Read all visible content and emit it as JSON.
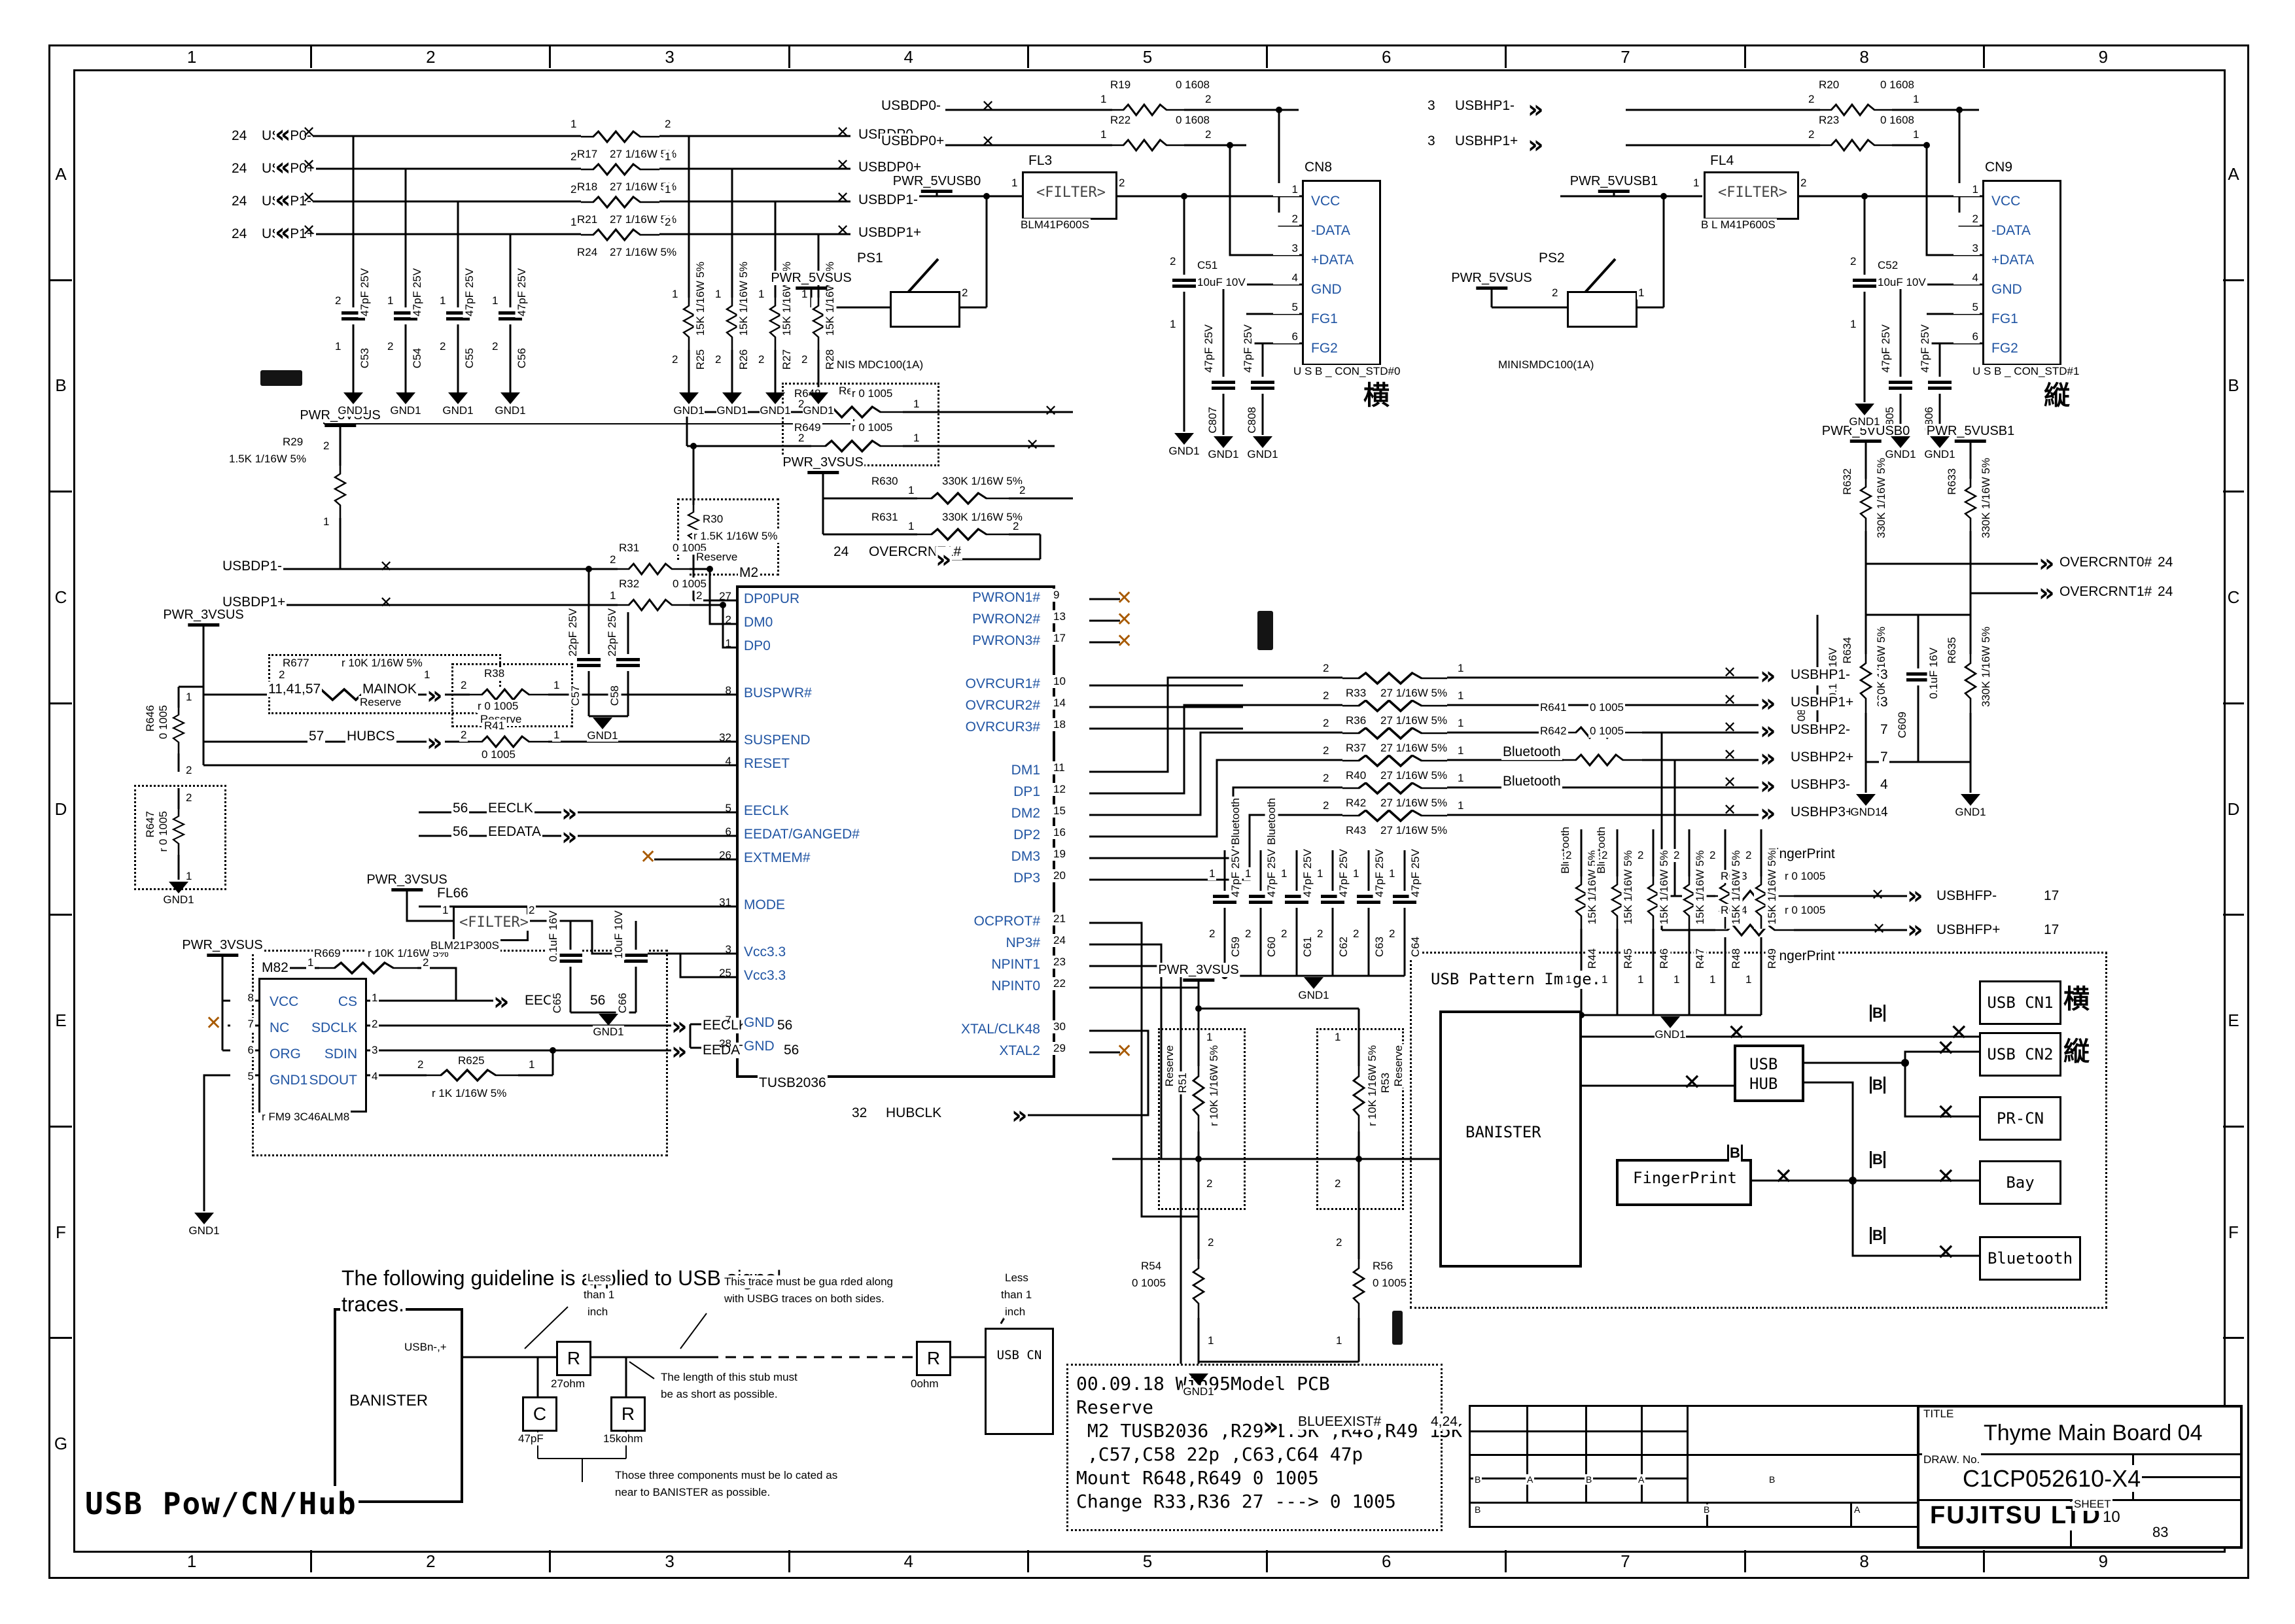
{
  "icons": {
    "chev_l": "«",
    "chev_r": "»",
    "x": "✕"
  },
  "sym": {
    "gnd": "GND1",
    "pwr3": "PWR_3VSUS",
    "pwr5": "PWR_5VSUS",
    "pwr5u0": "PWR_5VUSB0",
    "pwr5u1": "PWR_5VUSB1"
  },
  "frame": {
    "cols": [
      "1",
      "2",
      "3",
      "4",
      "5",
      "6",
      "7",
      "8",
      "9"
    ],
    "rows": [
      "A",
      "B",
      "C",
      "D",
      "E",
      "F",
      "G"
    ]
  },
  "big_label": "USB  Pow/CN/Hub",
  "title_block": {
    "title_label": "TITLE",
    "title": "Thyme Main Board 04",
    "draw_label": "DRAW. No.",
    "draw_no": "C1CP052610-X4",
    "company": "FUJITSU LTD.",
    "sheet_label": "SHEET",
    "sheet_no": "10",
    "sheet_total": "83"
  },
  "rev": {
    "r1": [
      "B",
      "A",
      "B",
      "A",
      "B"
    ],
    "r2": [
      "B",
      "B",
      "A"
    ]
  },
  "notes": {
    "lines": [
      "00.09.18 Win95Model PCB",
      "Reserve",
      " M2 TUSB2036 ,R29 1.5K ,R48,R49 15K",
      " ,C57,C58 22p ,C63,C64 47p",
      "Mount R648,R649 0 1005",
      "Change R33,R36 27 ---> 0 1005"
    ]
  },
  "inputs": {
    "rows": [
      {
        "page": "24",
        "net": "USBP0-",
        "ref": "R17",
        "val": "27 1/16W 5%",
        "pa": "1",
        "pb": "2",
        "out": "USBDP0-"
      },
      {
        "page": "24",
        "net": "USBP0+",
        "ref": "R18",
        "val": "27 1/16W 5%",
        "pa": "2",
        "pb": "1",
        "out": "USBDP0+"
      },
      {
        "page": "24",
        "net": "USBP1-",
        "ref": "R21",
        "val": "27 1/16W 5%",
        "pa": "2",
        "pb": "1",
        "out": "USBDP1-"
      },
      {
        "page": "24",
        "net": "USBP1+",
        "ref": "R24",
        "val": "27 1/16W 5%",
        "pa": "1",
        "pb": "2",
        "out": "USBDP1+"
      }
    ],
    "caps": [
      {
        "ref": "C53",
        "val": "47pF 25V",
        "pa": "2",
        "pb": "1"
      },
      {
        "ref": "C54",
        "val": "47pF 25V",
        "pa": "1",
        "pb": "2"
      },
      {
        "ref": "C55",
        "val": "47pF 25V",
        "pa": "1",
        "pb": "2"
      },
      {
        "ref": "C56",
        "val": "47pF 25V",
        "pa": "1",
        "pb": "2"
      }
    ],
    "pulls": [
      {
        "ref": "R25",
        "val": "15K 1/16W 5%",
        "pa": "1",
        "pb": "2"
      },
      {
        "ref": "R26",
        "val": "15K 1/16W 5%",
        "pa": "1",
        "pb": "2"
      },
      {
        "ref": "R27",
        "val": "15K 1/16W 5%",
        "pa": "1",
        "pb": "2"
      },
      {
        "ref": "R28",
        "val": "15K 1/16W 5%",
        "pa": "1",
        "pb": "2"
      }
    ]
  },
  "port0": {
    "net_m": "USBDP0-",
    "net_p": "USBDP0+",
    "rm": {
      "ref": "R19",
      "val": "0 1608",
      "pa": "1",
      "pb": "2"
    },
    "rp": {
      "ref": "R22",
      "val": "0 1608",
      "pa": "1",
      "pb": "2"
    },
    "fl": {
      "ref": "FL3",
      "text": "<FILTER>",
      "part": "BLM41P600S",
      "pa": "1",
      "pb": "2"
    },
    "ps": {
      "ref": "PS1",
      "part": "MINIS MDC100(1A)",
      "pb": "2"
    },
    "cap": {
      "ref": "C51",
      "val": "10uF 10V",
      "pa": "2",
      "pb": "1"
    },
    "c_a": {
      "ref": "C807",
      "val": "47pF 25V"
    },
    "c_b": {
      "ref": "C808",
      "val": "47pF 25V"
    },
    "cn": {
      "ref": "CN8",
      "part": "U S B _ CON_STD#0",
      "mark": "横",
      "nums": [
        "1",
        "2",
        "3",
        "4",
        "5",
        "6"
      ],
      "pins": [
        "VCC",
        "-DATA",
        "+DATA",
        "GND",
        "FG1",
        "FG2"
      ]
    }
  },
  "port1": {
    "net_m_pg": "3",
    "net_m": "USBHP1-",
    "net_p_pg": "3",
    "net_p": "USBHP1+",
    "rm": {
      "ref": "R20",
      "val": "0 1608",
      "pa": "2",
      "pb": "1"
    },
    "rp": {
      "ref": "R23",
      "val": "0 1608",
      "pa": "2",
      "pb": "1"
    },
    "fl": {
      "ref": "FL4",
      "text": "<FILTER>",
      "part": "B L M41P600S",
      "pa": "1",
      "pb": "2"
    },
    "ps": {
      "ref": "PS2",
      "part": "MINISMDC100(1A)",
      "pa": "2",
      "pb": "1"
    },
    "cap": {
      "ref": "C52",
      "val": "10uF 10V",
      "pa": "2",
      "pb": "1"
    },
    "c_a": {
      "ref": "C805",
      "val": "47pF 25V"
    },
    "c_b": {
      "ref": "C806",
      "val": "47pF 25V"
    },
    "cn": {
      "ref": "CN9",
      "part": "U S B _ CON_STD#1",
      "mark": "縦",
      "nums": [
        "1",
        "2",
        "3",
        "4",
        "5",
        "6"
      ],
      "pins": [
        "VCC",
        "-DATA",
        "+DATA",
        "GND",
        "FG1",
        "FG2"
      ]
    }
  },
  "chip": {
    "ref": "M2",
    "part": "TUSB2036",
    "left": [
      {
        "num": "27",
        "name": "DP0PUR"
      },
      {
        "num": "2",
        "name": "DM0"
      },
      {
        "num": "1",
        "name": "DP0"
      },
      {
        "num": "",
        "name": ""
      },
      {
        "num": "8",
        "name": "BUSPWR#"
      },
      {
        "num": "",
        "name": ""
      },
      {
        "num": "32",
        "name": "SUSPEND"
      },
      {
        "num": "4",
        "name": "RESET"
      },
      {
        "num": "",
        "name": ""
      },
      {
        "num": "5",
        "name": "EECLK"
      },
      {
        "num": "6",
        "name": "EEDAT/GANGED#"
      },
      {
        "num": "26",
        "name": "EXTMEM#"
      },
      {
        "num": "",
        "name": ""
      },
      {
        "num": "31",
        "name": "MODE"
      },
      {
        "num": "",
        "name": ""
      },
      {
        "num": "3",
        "name": "Vcc3.3"
      },
      {
        "num": "25",
        "name": "Vcc3.3"
      },
      {
        "num": "",
        "name": ""
      },
      {
        "num": "7",
        "name": "GND"
      },
      {
        "num": "28",
        "name": "GND"
      }
    ],
    "right": [
      {
        "num": "9",
        "name": "PWRON1#"
      },
      {
        "num": "13",
        "name": "PWRON2#"
      },
      {
        "num": "17",
        "name": "PWRON3#"
      },
      {
        "num": "",
        "name": ""
      },
      {
        "num": "10",
        "name": "OVRCUR1#"
      },
      {
        "num": "14",
        "name": "OVRCUR2#"
      },
      {
        "num": "18",
        "name": "OVRCUR3#"
      },
      {
        "num": "",
        "name": ""
      },
      {
        "num": "11",
        "name": "DM1"
      },
      {
        "num": "12",
        "name": "DP1"
      },
      {
        "num": "15",
        "name": "DM2"
      },
      {
        "num": "16",
        "name": "DP2"
      },
      {
        "num": "19",
        "name": "DM3"
      },
      {
        "num": "20",
        "name": "DP3"
      },
      {
        "num": "",
        "name": ""
      },
      {
        "num": "21",
        "name": "OCPROT#"
      },
      {
        "num": "24",
        "name": "NP3#"
      },
      {
        "num": "23",
        "name": "NPINT1"
      },
      {
        "num": "22",
        "name": "NPINT0"
      },
      {
        "num": "",
        "name": ""
      },
      {
        "num": "30",
        "name": "XTAL/CLK48"
      },
      {
        "num": "29",
        "name": "XTAL2"
      }
    ]
  },
  "hubclk": {
    "page": "32",
    "net": "HUBCLK"
  },
  "midleft": {
    "r29": {
      "ref": "R29",
      "val": "1.5K 1/16W 5%",
      "pa": "2",
      "pb": "1"
    },
    "net_m": "USBDP1-",
    "net_p": "USBDP1+",
    "r31": {
      "ref": "R31",
      "val": "0 1005",
      "pa": "2",
      "pb": "1"
    },
    "r32": {
      "ref": "R32",
      "val": "0 1005",
      "pa": "1",
      "pb": "2"
    },
    "r30": {
      "ref": "R30",
      "val": "r 1.5K 1/16W 5%",
      "note": "Reserve"
    },
    "r677": {
      "ref": "R677",
      "val": "r 10K 1/16W 5%",
      "note": "Reserve",
      "pa": "2",
      "pb": "1"
    },
    "mainok_pg": "11,41,57",
    "mainok": "MAINOK",
    "hubcs_pg": "57",
    "hubcs": "HUBCS",
    "r38": {
      "ref": "R38",
      "val": "r 0 1005",
      "note": "Reserve",
      "pa": "2",
      "pb": "1"
    },
    "r41": {
      "ref": "R41",
      "val": "0 1005",
      "pa": "2",
      "pb": "1"
    },
    "c57": {
      "ref": "C57",
      "val": "22pF 25V"
    },
    "c58": {
      "ref": "C58",
      "val": "22pF 25V"
    },
    "r646": {
      "ref": "R646",
      "val": "0 1005",
      "pa": "1",
      "pb": "2"
    },
    "r647": {
      "ref": "R647",
      "val": "r 0 1005",
      "pa": "2",
      "pb": "1"
    },
    "eeclk_pg": "56",
    "eeclk": "EECLK",
    "eedata_pg": "56",
    "eedata": "EEDATA"
  },
  "res648": {
    "reserve": "Reserve",
    "r648": {
      "ref": "R648",
      "val": "r 0 1005",
      "pa": "2",
      "pb": "1"
    },
    "r649": {
      "ref": "R649",
      "val": "r 0 1005",
      "pa": "2",
      "pb": "1"
    },
    "r630": {
      "ref": "R630",
      "val": "330K 1/16W 5%",
      "pa": "1",
      "pb": "2"
    },
    "r631": {
      "ref": "R631",
      "val": "330K 1/16W 5%",
      "pa": "1",
      "pb": "2"
    },
    "oc1": {
      "page": "24",
      "net": "OVERCRNT1#"
    }
  },
  "outputs": {
    "rows": [
      {
        "ref": "R33",
        "val": "27 1/16W 5%",
        "pa": "2",
        "pb": "1",
        "net": "USBHP1-",
        "page": "3"
      },
      {
        "ref": "R36",
        "val": "27 1/16W 5%",
        "pa": "2",
        "pb": "1",
        "net": "USBHP1+",
        "page": "3"
      },
      {
        "ref": "R37",
        "val": "27 1/16W 5%",
        "pa": "2",
        "pb": "1",
        "net": "USBHP2-",
        "page": "7"
      },
      {
        "ref": "R40",
        "val": "27 1/16W 5%",
        "pa": "2",
        "pb": "1",
        "net": "USBHP2+",
        "page": "7"
      },
      {
        "ref": "R42",
        "val": "27 1/16W 5%",
        "pa": "2",
        "pb": "1",
        "net": "USBHP3-",
        "page": "4"
      },
      {
        "ref": "R43",
        "val": "27 1/16W 5%",
        "pa": "2",
        "pb": "1",
        "net": "USBHP3+",
        "page": "4"
      }
    ],
    "r641": {
      "ref": "R641",
      "val": "0 1005"
    },
    "r642": {
      "ref": "R642",
      "val": "0 1005"
    },
    "bt1": "Bluetooth",
    "bt2": "Bluetooth",
    "pulls": [
      {
        "ref": "R44",
        "val": "15K 1/16W 5%",
        "bt": "Bluetooth",
        "pa": "2",
        "pb": "1"
      },
      {
        "ref": "R45",
        "val": "15K 1/16W 5%",
        "bt": "Bluetooth",
        "pa": "2",
        "pb": "1"
      },
      {
        "ref": "R46",
        "val": "15K 1/16W 5%",
        "bt": "",
        "pa": "2",
        "pb": "1"
      },
      {
        "ref": "R47",
        "val": "15K 1/16W 5%",
        "bt": "",
        "pa": "2",
        "pb": "1"
      },
      {
        "ref": "R48",
        "val": "15K 1/16W 5%",
        "bt": "",
        "pa": "2",
        "pb": "1"
      },
      {
        "ref": "R49",
        "val": "15K 1/16W 5%",
        "bt": "",
        "pa": "2",
        "pb": "1"
      }
    ],
    "caps": [
      {
        "ref": "C59",
        "val": "47pF 25V",
        "bt": "Bluetooth",
        "pa": "1",
        "pb": "2"
      },
      {
        "ref": "C60",
        "val": "47pF 25V",
        "bt": "Bluetooth",
        "pa": "1",
        "pb": "2"
      },
      {
        "ref": "C61",
        "val": "47pF 25V",
        "bt": "",
        "pa": "1",
        "pb": "2"
      },
      {
        "ref": "C62",
        "val": "47pF 25V",
        "bt": "",
        "pa": "1",
        "pb": "2"
      },
      {
        "ref": "C63",
        "val": "47pF 25V",
        "bt": "",
        "pa": "1",
        "pb": "2"
      },
      {
        "ref": "C64",
        "val": "47pF 25V",
        "bt": "",
        "pa": "1",
        "pb": "2"
      }
    ]
  },
  "fp": {
    "label1": "FingerPrint",
    "label2": "FingerPrint",
    "r643": {
      "ref": "R643",
      "val": "r 0 1005"
    },
    "r644": {
      "ref": "R644",
      "val": "r 0 1005"
    },
    "net_m": "USBHFP-",
    "page_m": "17",
    "net_p": "USBHFP+",
    "page_p": "17"
  },
  "pullups": {
    "r632": {
      "ref": "R632",
      "val": "330K 1/16W 5%"
    },
    "r633": {
      "ref": "R633",
      "val": "330K 1/16W 5%"
    },
    "r634": {
      "ref": "R634",
      "val": "330K 1/16W 5%"
    },
    "r635": {
      "ref": "R635",
      "val": "330K 1/16W 5%"
    },
    "c609": {
      "ref": "C609",
      "val": "0.1uF 16V"
    },
    "c608": {
      "ref": "C608",
      "val": "0.1uF 16V"
    },
    "oc0": {
      "net": "OVERCRNT0#",
      "page": "24"
    },
    "oc1": {
      "net": "OVERCRNT1#",
      "page": "24"
    }
  },
  "eeprom": {
    "m82": {
      "ref": "M82",
      "part": "r FM9 3C46ALM8",
      "left": [
        {
          "num": "8",
          "name": "VCC"
        },
        {
          "num": "7",
          "name": "NC"
        },
        {
          "num": "6",
          "name": "ORG"
        },
        {
          "num": "5",
          "name": "GND1"
        }
      ],
      "right": [
        {
          "num": "1",
          "name": "CS"
        },
        {
          "num": "2",
          "name": "SDCLK"
        },
        {
          "num": "3",
          "name": "SDIN"
        },
        {
          "num": "4",
          "name": "SDOUT"
        }
      ]
    },
    "r669": {
      "ref": "R669",
      "val": "r 10K 1/16W 5%",
      "pa": "1",
      "pb": "2"
    },
    "r625": {
      "ref": "R625",
      "val": "r 1K 1/16W 5%",
      "pa": "2",
      "pb": "1"
    },
    "eecs": {
      "net": "EECS",
      "page": "56"
    },
    "eeclk": {
      "net": "EECLK",
      "page": "56"
    },
    "eedata": {
      "net": "EEDATA",
      "page": "56"
    },
    "fl66": {
      "ref": "FL66",
      "text": "<FILTER>",
      "part": "BLM21P300S",
      "pa": "1",
      "pb": "2"
    },
    "c65": {
      "ref": "C65",
      "val": "0.1uF 16V"
    },
    "c66": {
      "ref": "C66",
      "val": "10uF 10V"
    }
  },
  "blue": {
    "r51": {
      "ref": "R51",
      "val": "r 10K 1/16W 5%",
      "note": "Reserve",
      "pa": "1",
      "pb": "2"
    },
    "r53": {
      "ref": "R53",
      "val": "r 10K 1/16W 5%",
      "note": "Reserve",
      "pa": "1",
      "pb": "2"
    },
    "r54": {
      "ref": "R54",
      "val": "0 1005",
      "pa": "2",
      "pb": "1"
    },
    "r56": {
      "ref": "R56",
      "val": "0 1005",
      "pa": "2",
      "pb": "1"
    },
    "net": "BLUEEXIST#",
    "page": "4,24"
  },
  "pattern": {
    "heading": "USB Pattern Image.",
    "banister": "BANISTER",
    "hub1": "USB",
    "hub2": "HUB",
    "fingerprint": "FingerPrint",
    "cn1": "USB CN1",
    "cn2": "USB CN2",
    "prcn": "PR-CN",
    "bay": "Bay",
    "bt": "Bluetooth",
    "cn1_mark": "横",
    "cn2_mark": "縦"
  },
  "guide": {
    "h1": "The following guideline is applied to USB signal",
    "h2": "traces.",
    "banister": "BANISTER",
    "usb_cn": "USB CN",
    "sig": "USBn-,+",
    "r": "R",
    "c": "C",
    "r1v": "27ohm",
    "cv": "47pF",
    "r2v": "15kohm",
    "r3v": "0ohm",
    "less1": "Less",
    "less2": "than 1",
    "less3": "inch",
    "guard1": "This trace must be gua rded along",
    "guard2": "with USBG traces on  both sides.",
    "stub1": "The length of this  stub must",
    "stub2": "be as short  as possible.",
    "three1": "Those three components must be lo cated as",
    "three2": "near to BANISTER  as possible."
  }
}
